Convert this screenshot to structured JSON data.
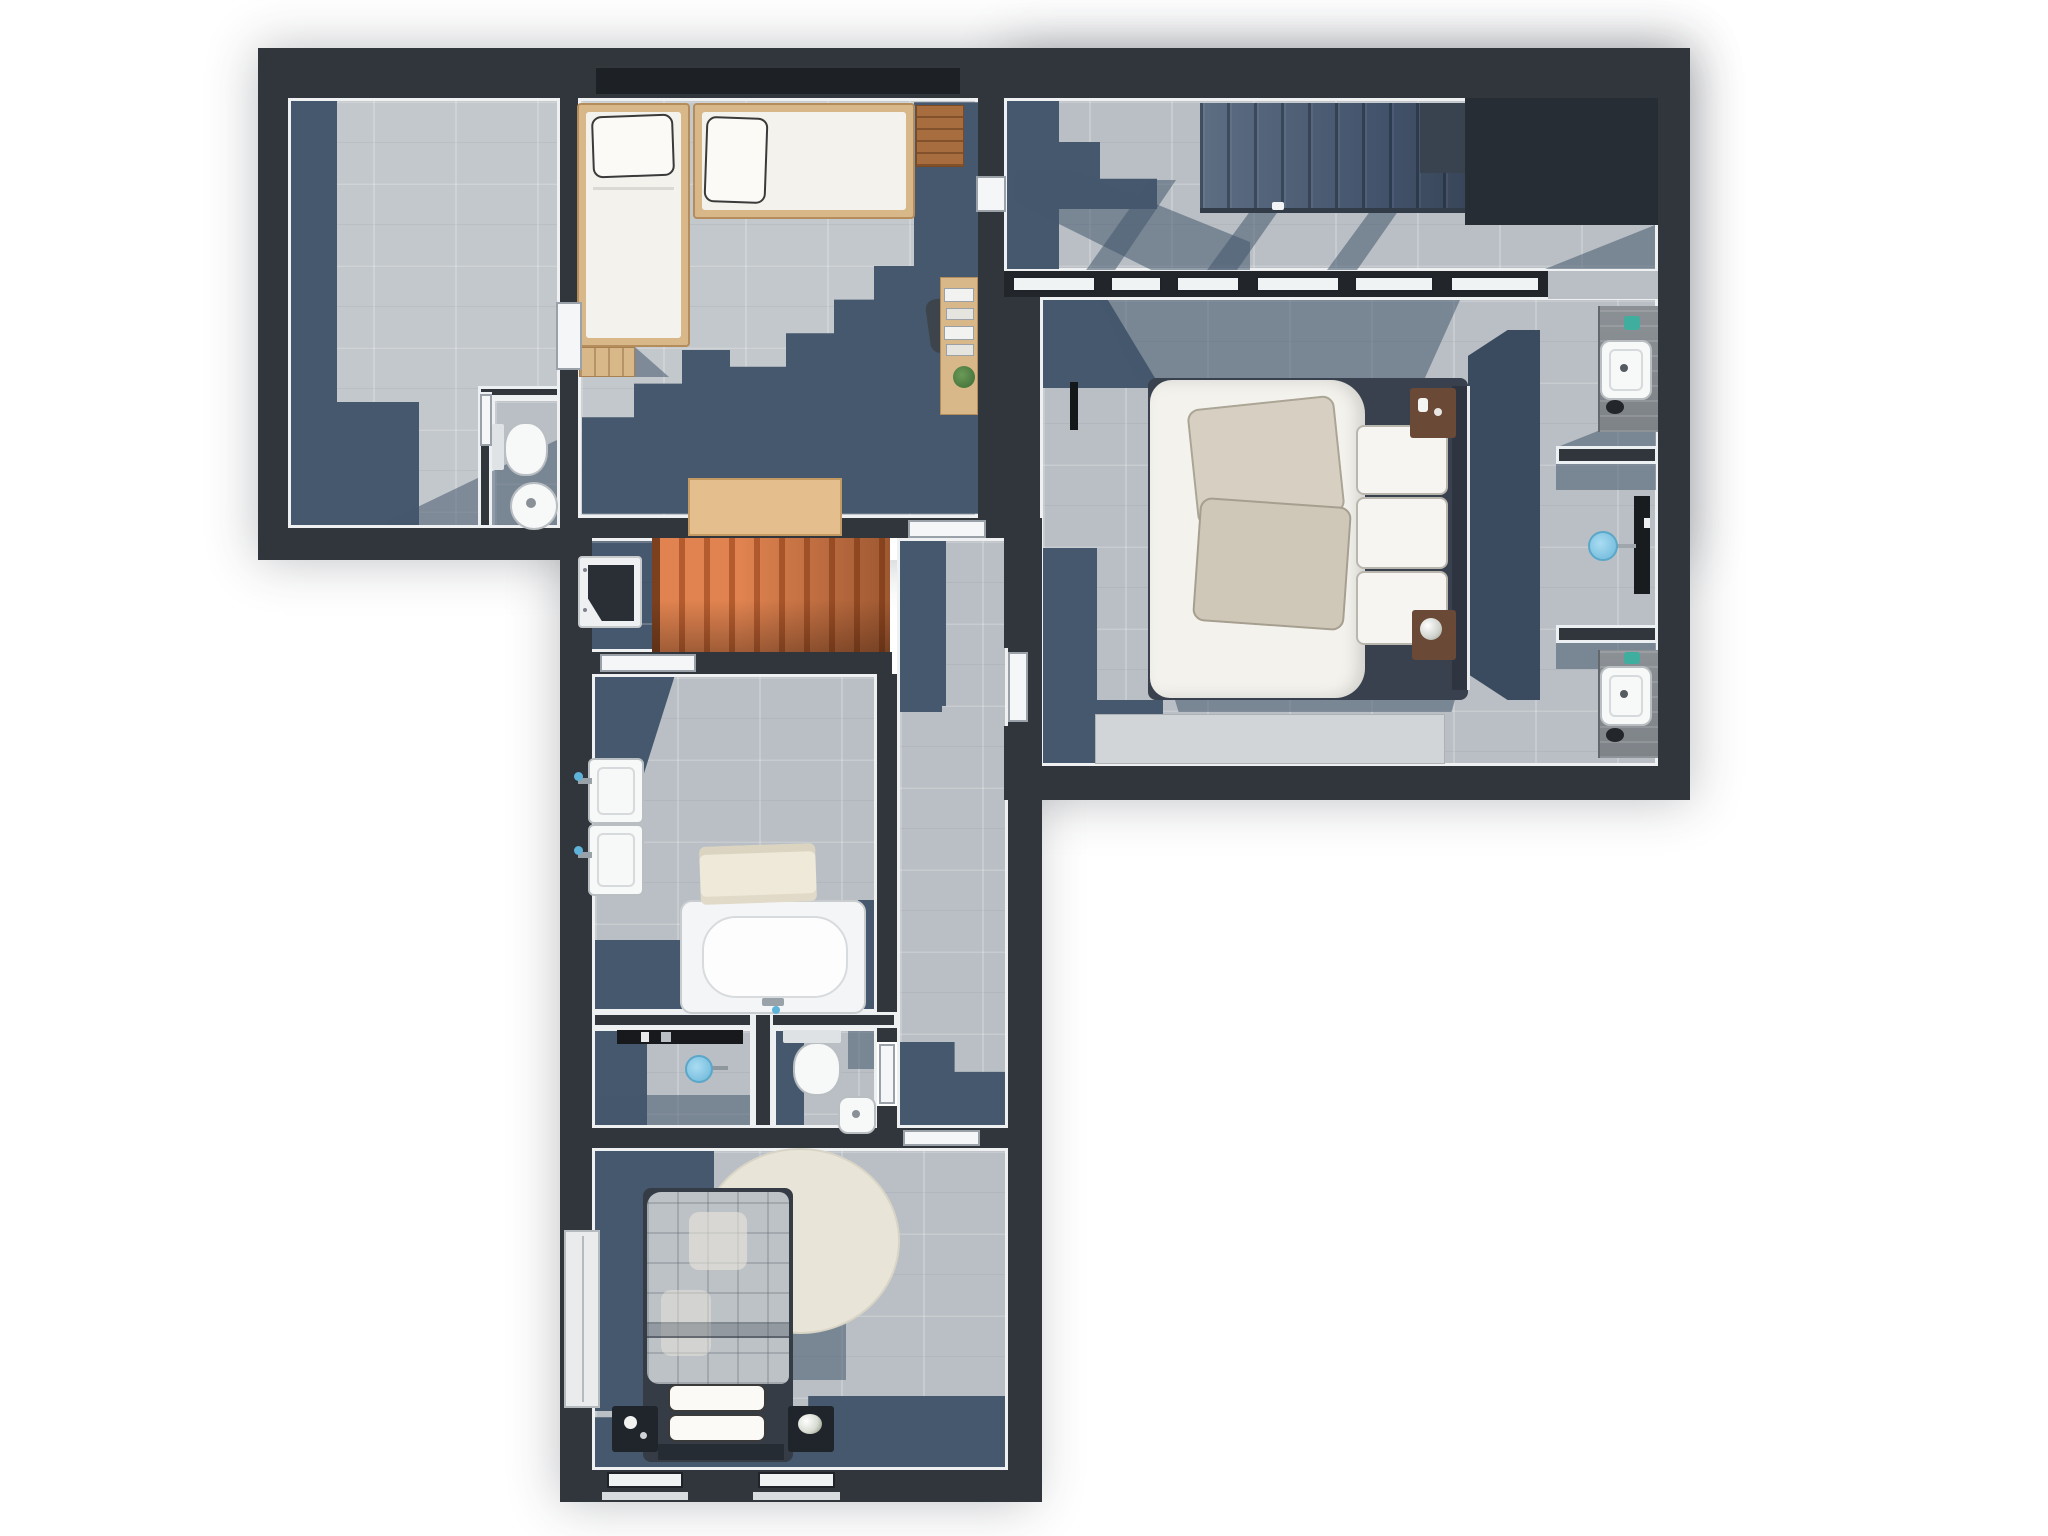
{
  "meta": {
    "kind": "floor-plan",
    "view": "top-down 3d render",
    "floor_label": "upper floor",
    "background": "#ffffff"
  },
  "palette": {
    "wall": "#31363c",
    "wall_void": "#272d35",
    "trim_white": "#edf0f2",
    "floor_tile_light": "#c3c8cc",
    "floor_tile_mid": "#b9bfc4",
    "floor_accent_navy": "#46586d",
    "stairs_slate": "#4a5a6e",
    "stairs_orange": "#e08350",
    "wood_light": "#d8b789",
    "wood_bench": "#a86d3e",
    "fixture_white": "#f7f8f8",
    "shower_blue": "#82c8e6",
    "faucet_blue": "#5fb3d9",
    "rug_cream": "#e8e4d7",
    "plant_green": "#4a7a3d",
    "nightstand_brown": "#6a4936",
    "nightstand_black": "#20252b",
    "bedding_white": "#f3f2ed",
    "pillow_beige": "#d7cfc1",
    "duvet_plaid_gray": "#bdc2c6"
  },
  "rooms": [
    {
      "id": "storage-room",
      "name": "Dressing / storage room",
      "furniture": []
    },
    {
      "id": "wc-top",
      "name": "WC (top, with wall-hung toilet and round basin)",
      "furniture": [
        "wall-hung toilet",
        "round basin",
        "door"
      ]
    },
    {
      "id": "bedroom-twin",
      "name": "Bedroom with two single beds",
      "furniture": [
        "single bed vertical",
        "single bed horizontal",
        "bed steps",
        "wooden bench",
        "desk with books",
        "desk chair",
        "plant"
      ]
    },
    {
      "id": "landing",
      "name": "Landing / stairwell with dark staircase",
      "furniture": [
        "staircase dark",
        "stairwell void",
        "glazed partition"
      ]
    },
    {
      "id": "master-bedroom",
      "name": "Master bedroom",
      "furniture": [
        "double bed",
        "beige pillows",
        "white pillows",
        "headboard",
        "nightstand with bottles",
        "nightstand with flowers",
        "wall tv",
        "low dresser"
      ]
    },
    {
      "id": "ensuite",
      "name": "Ensuite niches (two vanities and shower)",
      "furniture": [
        "vanity counter top",
        "sink",
        "shower column",
        "shower head",
        "vanity counter bottom",
        "sink"
      ]
    },
    {
      "id": "stair-hall",
      "name": "Stair hall with orange staircase",
      "furniture": [
        "orange staircase",
        "wooden landing platform",
        "appliance niche"
      ]
    },
    {
      "id": "corridor",
      "name": "Hallway",
      "furniture": []
    },
    {
      "id": "bathroom",
      "name": "Bathroom",
      "furniture": [
        "double sink vanity",
        "bathtub",
        "towel",
        "shower shelf",
        "shower head"
      ]
    },
    {
      "id": "shower-area",
      "name": "Open shower area",
      "furniture": [
        "shower shelf",
        "shower head"
      ]
    },
    {
      "id": "wc-mid",
      "name": "WC (middle, with wall-hung toilet and small basin)",
      "furniture": [
        "wall-hung toilet",
        "small basin"
      ]
    },
    {
      "id": "bedroom-bottom",
      "name": "Bedroom with double bed and round rug",
      "furniture": [
        "double bed plaid duvet",
        "two pillows",
        "headboard",
        "black nightstand with lamp",
        "black nightstand with flowers",
        "round cream rug",
        "wardrobe",
        "two windows"
      ]
    }
  ],
  "counts": {
    "bedrooms": 3,
    "wcs": 2,
    "bathrooms": 1,
    "staircases": 2,
    "sinks_total": 7
  }
}
